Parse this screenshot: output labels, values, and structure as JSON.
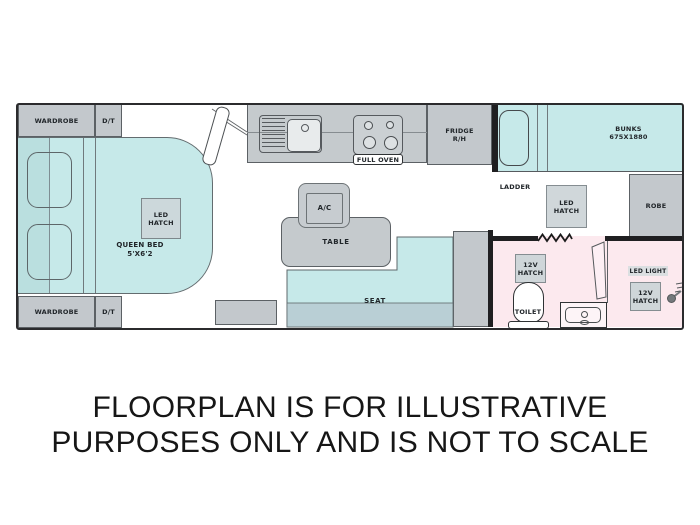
{
  "labels": {
    "wardrobe_top": "WARDROBE",
    "dt_top": "D/T",
    "wardrobe_bottom": "WARDROBE",
    "dt_bottom": "D/T",
    "queen_l1": "QUEEN BED",
    "queen_l2": "5'X6'2",
    "led": "LED",
    "hatch": "HATCH",
    "v12": "12V",
    "full_oven": "FULL OVEN",
    "fridge_l1": "FRIDGE",
    "fridge_l2": "R/H",
    "bunks_l1": "BUNKS",
    "bunks_l2": "675X1880",
    "ladder": "LADDER",
    "robe": "ROBE",
    "con_door": "CON.DOOR",
    "ac": "A/C",
    "table": "TABLE",
    "seat": "SEAT",
    "toilet": "TOILET",
    "led_light": "LED LIGHT"
  },
  "caption": {
    "line1": "FLOORPLAN IS FOR ILLUSTRATIVE",
    "line2": "PURPOSES ONLY AND IS NOT TO SCALE"
  },
  "colors": {
    "teal": "#c6e9e9",
    "teal_strip": "#badfdf",
    "teal_band": "#b9cfd5",
    "gray": "#c5cacd",
    "graybox": "#c3c8cc",
    "hatch": "#cfd6d9",
    "pink": "#fce9ee",
    "wall": "#1f1f21",
    "ink": "#21262a"
  }
}
